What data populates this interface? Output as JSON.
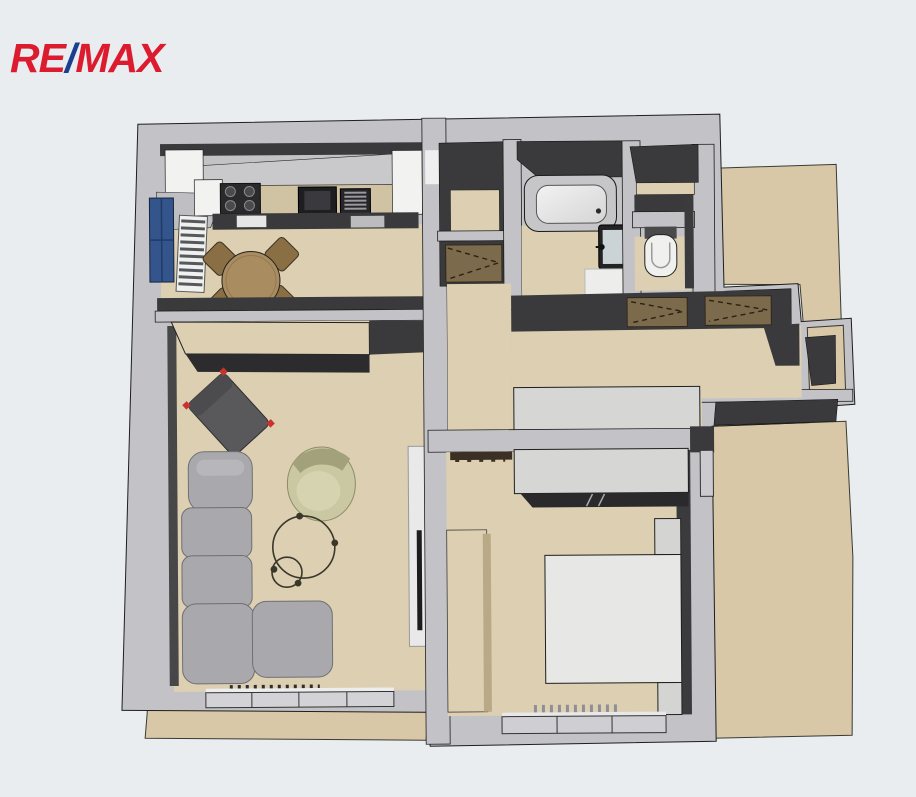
{
  "app": {
    "type": "real-estate-floor-plan-render",
    "description": "3D top-down rendered floor plan of a one-bedroom apartment with kitchen-dining room, living room, entrance hall, bathroom, separate WC, bedroom and balcony"
  },
  "logo": {
    "re": "RE",
    "slash": "/",
    "max": "MAX"
  },
  "colors": {
    "background": "#E9EDF0",
    "wallTop": "#C3C3C7",
    "wallDark": "#3A3A3C",
    "floor": "#DCCFB2",
    "floorExterior": "#D8C8A7",
    "counter": "#CFC3A4",
    "white": "#F2F2F1",
    "sofa": "#A9A9AD",
    "chairDark": "#59595B",
    "accentRed": "#C8332F",
    "armchair": "#CAC7A3",
    "wood": "#A98C5F",
    "wardrobeTop": "#7B6A4C",
    "slab": "#D6D6D4",
    "tub": "#C6C6C8",
    "blueWindow": "#34558B",
    "logoRed": "#DC1C2E",
    "logoBlue": "#1B3E90"
  },
  "rooms": [
    {
      "id": "kitchen-dining",
      "furniture": [
        "kitchen counter",
        "cooktop",
        "sink",
        "oven column",
        "white cabinets",
        "round dining table",
        "4 chairs",
        "window",
        "radiator"
      ]
    },
    {
      "id": "living-room",
      "furniture": [
        "sideboard",
        "dark lounge chair with red corners",
        "olive armchair",
        "two round coffee tables",
        "gray corner sofa",
        "radiator",
        "window",
        "wall TV panel"
      ]
    },
    {
      "id": "entrance-hall",
      "furniture": [
        "entrance closet",
        "two wardrobes",
        "low cabinet"
      ]
    },
    {
      "id": "pantry-closet",
      "furniture": []
    },
    {
      "id": "bathroom",
      "furniture": [
        "bathtub",
        "washbasin",
        "bath mat"
      ]
    },
    {
      "id": "wc",
      "furniture": [
        "toilet",
        "shelf"
      ]
    },
    {
      "id": "bedroom",
      "furniture": [
        "sliding wardrobe",
        "double bed",
        "two nightstands",
        "tall cabinet",
        "coat rail",
        "radiator",
        "window"
      ]
    },
    {
      "id": "balcony",
      "furniture": []
    },
    {
      "id": "common-corridor",
      "furniture": []
    }
  ]
}
